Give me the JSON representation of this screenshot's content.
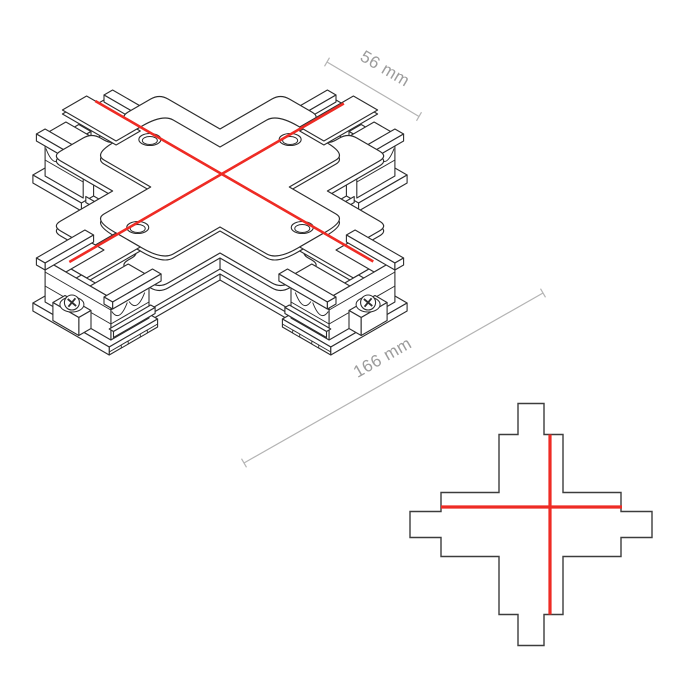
{
  "figure": {
    "type": "technical-drawing",
    "views": {
      "isometric": "isometric-view",
      "plan": "plan-view"
    }
  },
  "annotations": {
    "dim_arm_width": {
      "label": "56 mm"
    },
    "dim_total_length": {
      "label": "166 mm"
    }
  },
  "colors": {
    "background": "#ffffff",
    "line_art": "#2d2d2d",
    "accent_red": "#ee2b24",
    "dimension_line": "#b4b4b4",
    "dimension_text": "#9c9c9c",
    "plan_outline": "#3c3c3c"
  }
}
